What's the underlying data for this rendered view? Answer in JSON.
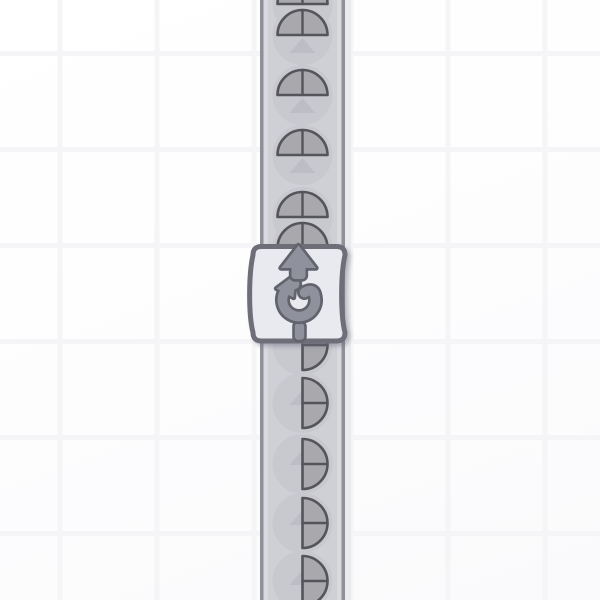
{
  "scene": {
    "description": "factory game canvas: vertical conveyor belt carrying half-circle shapes upward through a counter-clockwise rotator building",
    "visible_text": []
  },
  "colors": {
    "background": "#fdfdfe",
    "grid_line": "#f5f5f7",
    "belt_fill": "#cfcfd6",
    "belt_edge": "#90909a",
    "belt_edge_highlight": "#d9d9de",
    "belt_shadow": "#eaeaee",
    "belt_arrow": "#bdbdc5",
    "item_disc": "#c8c8cf",
    "shape_fill": "#a8a8ad",
    "shape_outline": "#54545a",
    "building_fill": "#e9eaf0",
    "building_border": "#6e6e79",
    "icon_fill": "#8f919d",
    "icon_outline": "#63636d"
  },
  "grid": {
    "vertical_lines_x": [
      60,
      157,
      254,
      351,
      448,
      545
    ],
    "horizontal_lines_y": [
      53.5,
      149.5,
      245.5,
      341.5,
      437.5,
      533.5
    ],
    "line_width": 5
  },
  "belt": {
    "x": 260,
    "width": 85,
    "center_x": 302.5,
    "direction": "up",
    "arrow_tips_y": [
      38,
      98,
      158,
      390,
      450,
      510,
      570
    ]
  },
  "item_style": {
    "shape_radius": 25,
    "disc_radius": 30
  },
  "items": [
    {
      "shape": "circle-half-top",
      "cy": 4,
      "note": "cut at top edge"
    },
    {
      "shape": "circle-half-top",
      "cy": 35
    },
    {
      "shape": "circle-half-top",
      "cy": 95
    },
    {
      "shape": "circle-half-top",
      "cy": 155
    },
    {
      "shape": "circle-half-top",
      "cy": 217
    },
    {
      "shape": "circle-half-top",
      "cy": 248,
      "note": "partially behind rotator"
    },
    {
      "shape": "circle-half-right",
      "cy": 345,
      "note": "partially behind rotator"
    },
    {
      "shape": "circle-half-right",
      "cy": 403
    },
    {
      "shape": "circle-half-right",
      "cy": 464
    },
    {
      "shape": "circle-half-right",
      "cy": 523
    },
    {
      "shape": "circle-half-right",
      "cy": 581,
      "note": "cut at bottom edge"
    }
  ],
  "building": {
    "type": "rotator-counterclockwise",
    "x": 250.5,
    "y": 244,
    "width": 97,
    "height": 99.5,
    "input_side": "bottom",
    "output_side": "top",
    "icons": [
      "up-arrow-icon",
      "rotate-ccw-icon"
    ]
  }
}
